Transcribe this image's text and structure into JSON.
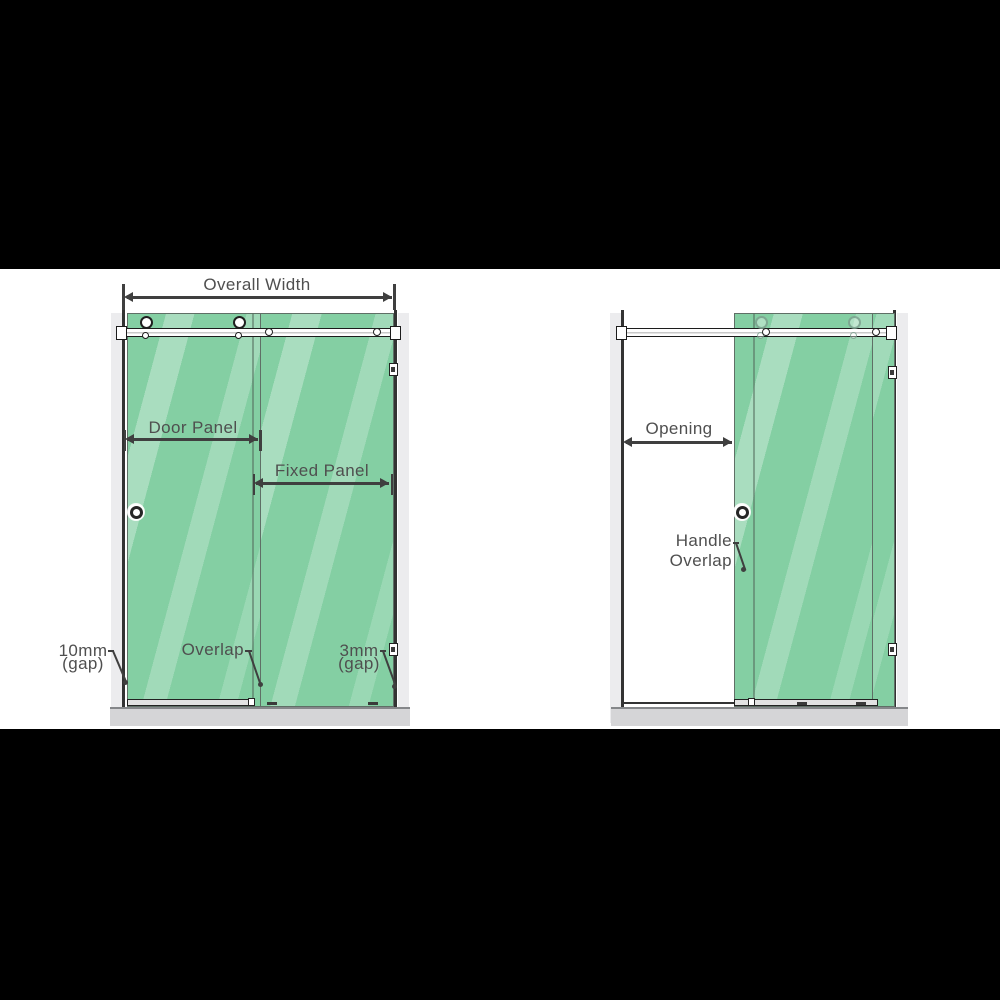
{
  "image": {
    "description": "Sliding shower screen dimension diagram, closed and open configurations",
    "frame_color": "#000000",
    "stage_background": "#ffffff"
  },
  "colors": {
    "glass_green": "#84cfa3",
    "glass_streak": "#aee0c4",
    "hardware_outline": "#1f1f1f",
    "dimension_lines": "#3f3f3f",
    "label_text": "#4f4f4f",
    "tray_gray": "#d5d5d7",
    "wall_shadow": "#ececee"
  },
  "left_diagram": {
    "name": "closed-door-elevation",
    "labels": {
      "overall_width": "Overall Width",
      "door_panel": "Door Panel",
      "fixed_panel": "Fixed Panel",
      "overlap": "Overlap",
      "left_gap_value": "10mm",
      "left_gap_unit": "(gap)",
      "right_gap_value": "3mm",
      "right_gap_unit": "(gap)"
    }
  },
  "right_diagram": {
    "name": "open-door-elevation",
    "labels": {
      "opening": "Opening",
      "handle_overlap_line1": "Handle",
      "handle_overlap_line2": "Overlap"
    }
  }
}
